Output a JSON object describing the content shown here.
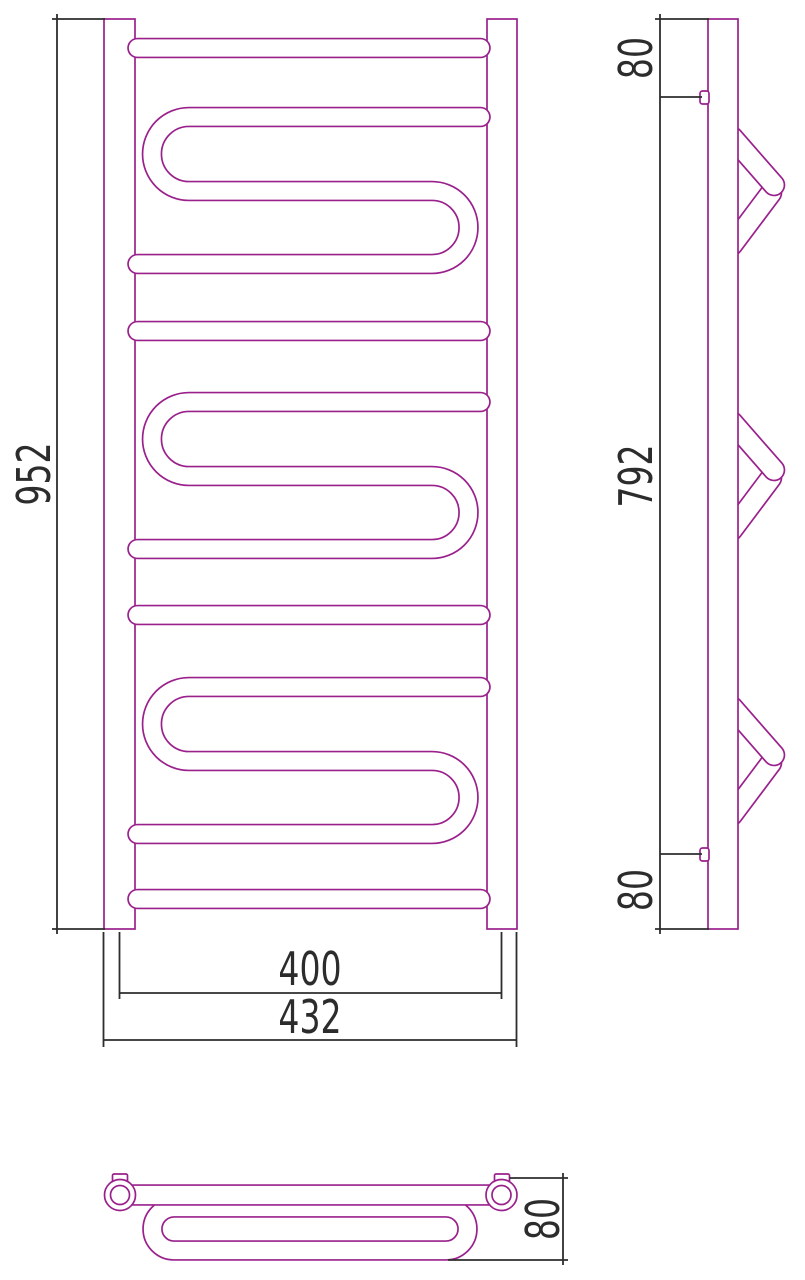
{
  "document": {
    "type": "technical-drawing",
    "subject": "heated towel rail, orthographic views"
  },
  "colors": {
    "outline": "#9A218C",
    "dimension": "#2D2D2D",
    "background": "#FFFFFF"
  },
  "front_view": {
    "height": "952",
    "axis_width": "400",
    "overall_width": "432"
  },
  "side_view": {
    "top_offset": "80",
    "bracket_spacing": "792",
    "bottom_offset": "80"
  },
  "plan_view": {
    "depth": "80"
  }
}
